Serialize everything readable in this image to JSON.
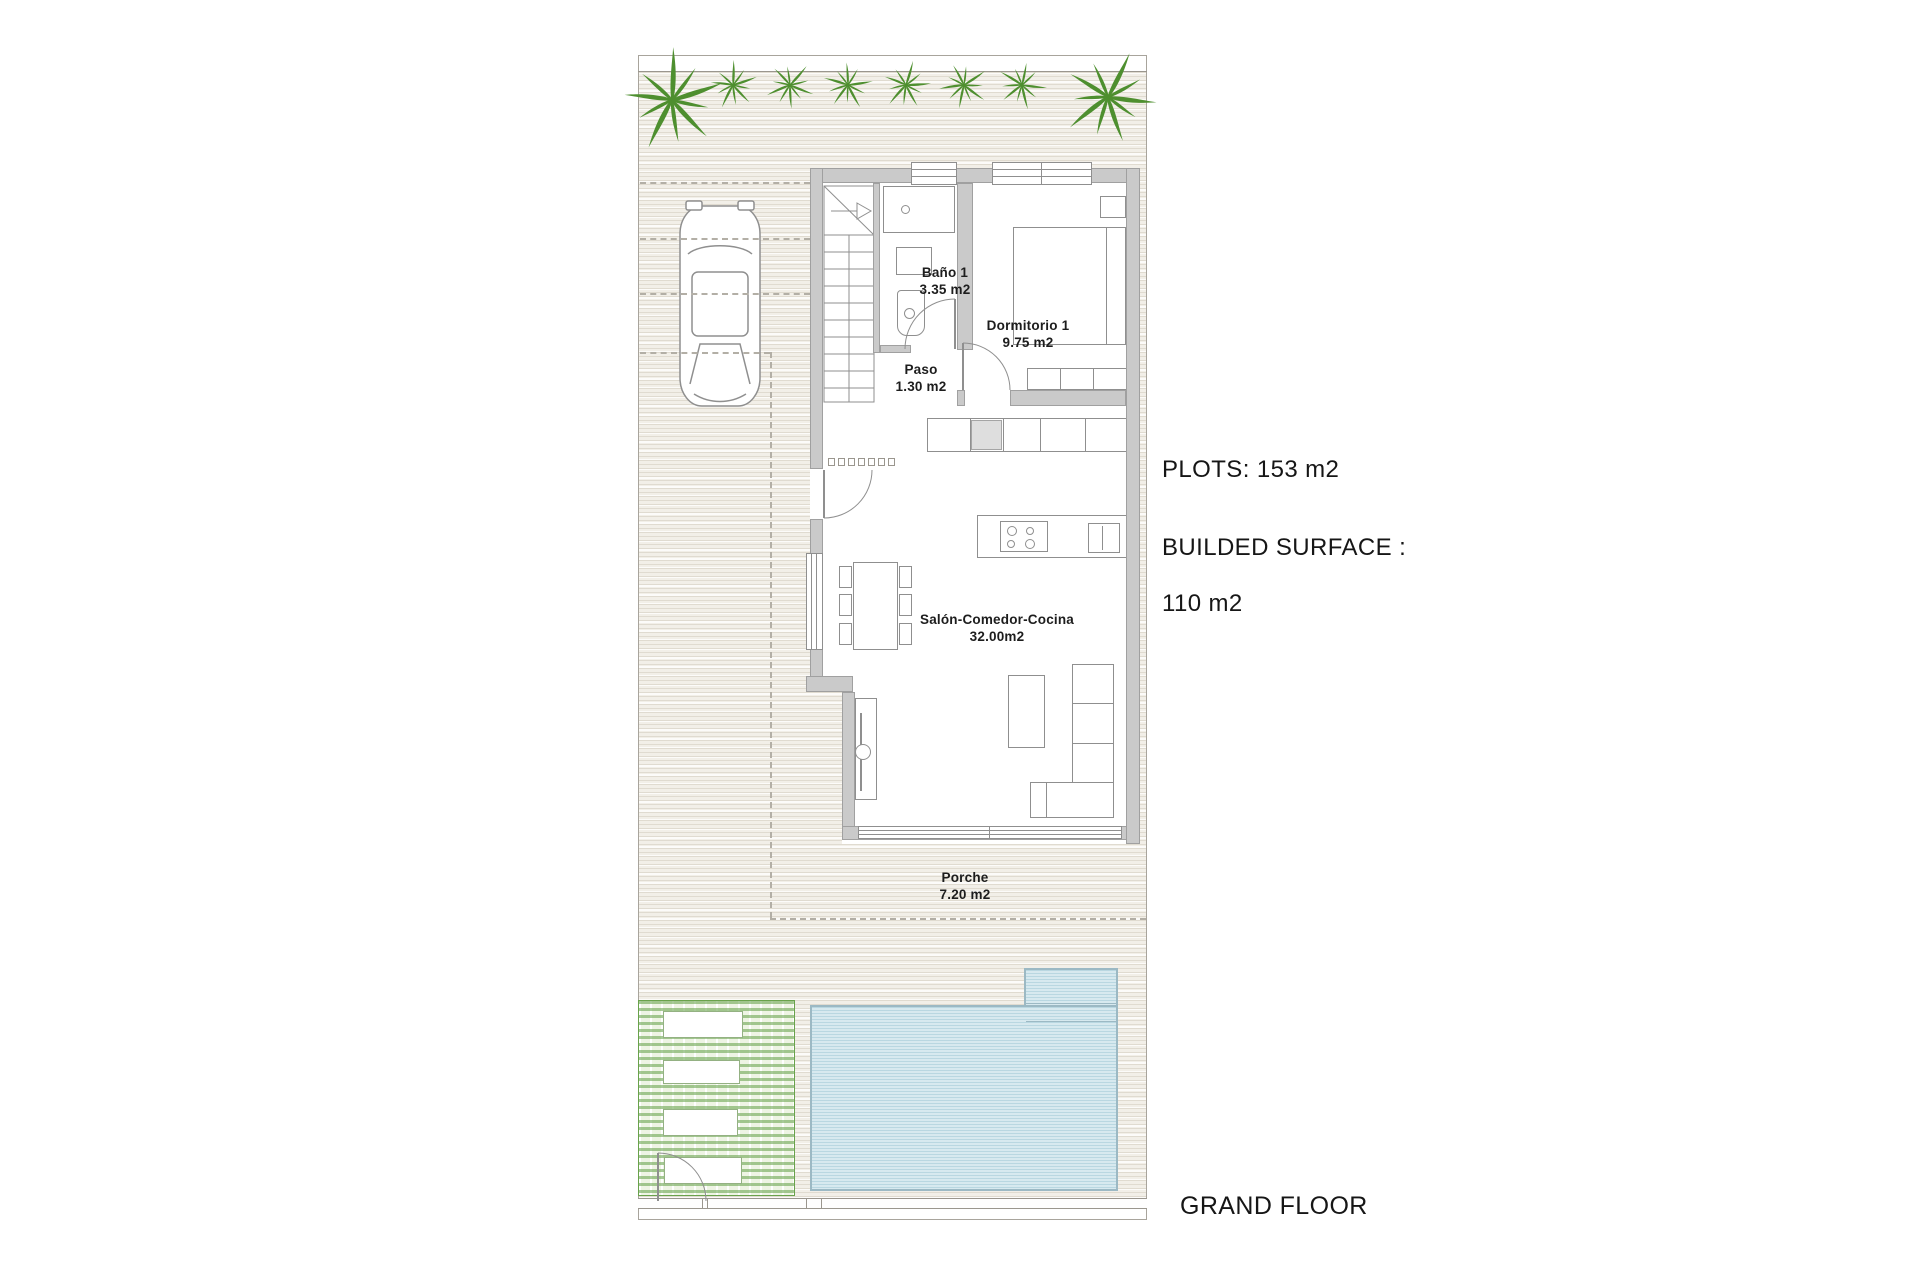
{
  "annotations": {
    "plots": "PLOTS: 153 m2",
    "built_line1": "BUILDED SURFACE :",
    "built_line2": "110 m2",
    "floor": "GRAND FLOOR"
  },
  "rooms": {
    "bathroom": {
      "name": "Baño 1",
      "area": "3.35 m2"
    },
    "bedroom": {
      "name": "Dormitorio 1",
      "area": "9.75 m2"
    },
    "hall": {
      "name": "Paso",
      "area": "1.30 m2"
    },
    "living": {
      "name": "Salón-Comedor-Cocina",
      "area": "32.00m2"
    },
    "porch": {
      "name": "Porche",
      "area": "7.20 m2"
    }
  },
  "colors": {
    "wall-fill": "#cacaca",
    "wall-edge": "#a0a0a0",
    "line": "#8f8f8f",
    "ground-base": "#f2efe8",
    "ground-stripe": "#e0dbd0",
    "pool-fill": "#d7e9ef",
    "pool-stripe": "#b9d7e1",
    "pool-edge": "#9cb9c4",
    "deck-green": "#5f9e43",
    "palm-green": "#4e8f2f",
    "text": "#1d1d1d"
  }
}
